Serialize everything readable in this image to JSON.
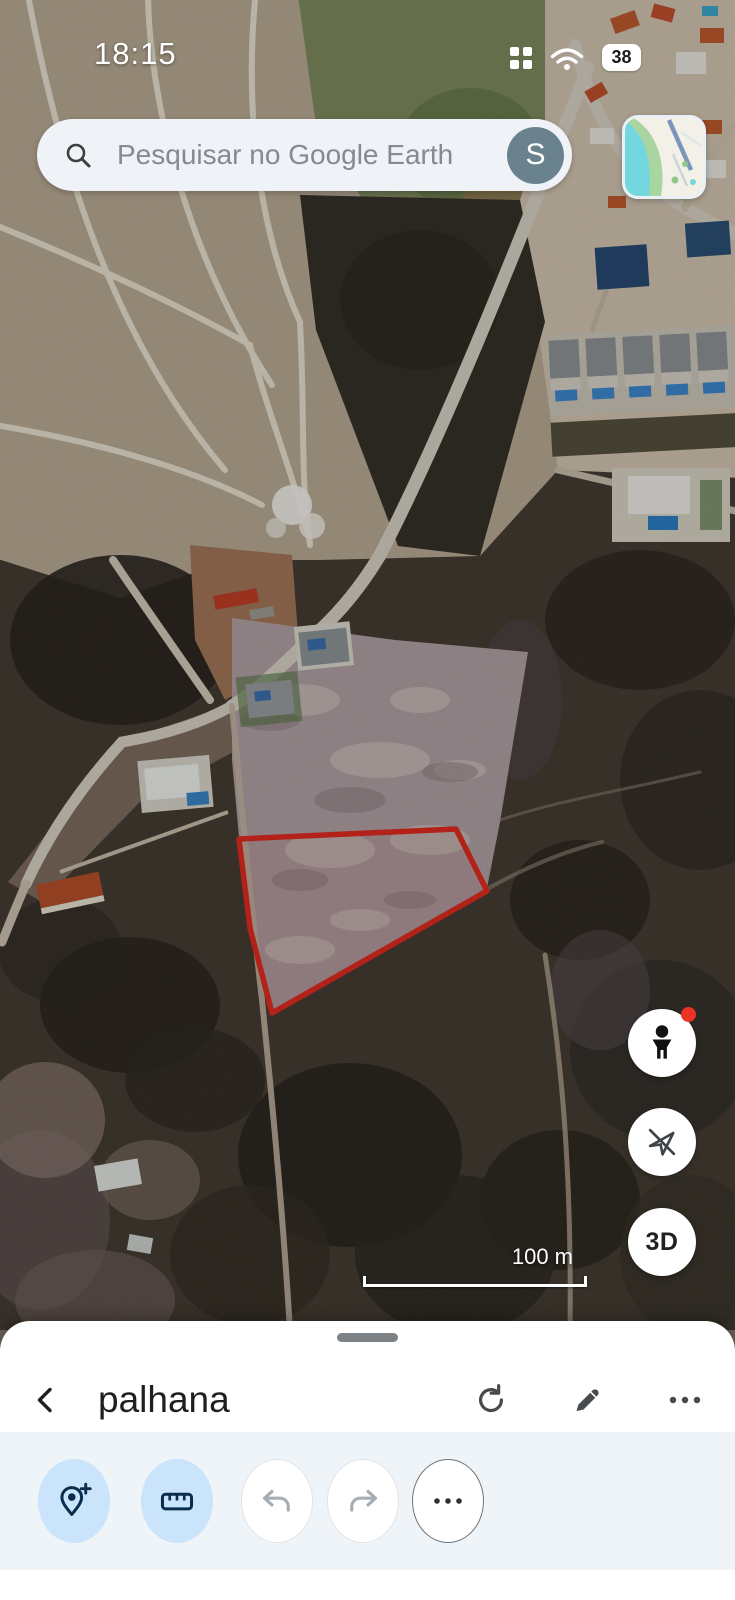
{
  "status_bar": {
    "time": "18:15",
    "battery_percent": "38"
  },
  "search_bar": {
    "placeholder": "Pesquisar no Google Earth",
    "avatar_letter": "S"
  },
  "map": {
    "scale_label": "100 m",
    "three_d_label": "3D",
    "right_buttons": [
      "street-view-pegman",
      "location-disabled",
      "3d-toggle"
    ],
    "overlay": "red-boundary-polygon"
  },
  "bottom_sheet": {
    "title": "palhana",
    "header_icons": [
      "back",
      "refresh",
      "edit-pencil",
      "more-options"
    ],
    "toolbar_icons": [
      "add-placemark",
      "measure-ruler",
      "undo",
      "redo",
      "more-tools"
    ]
  },
  "colors": {
    "polygon_red": "#e02b20",
    "tool_accent_blue": "#c9e4fb",
    "tool_icon_navy": "#0b2d4d",
    "avatar_slate": "#6a828e"
  }
}
